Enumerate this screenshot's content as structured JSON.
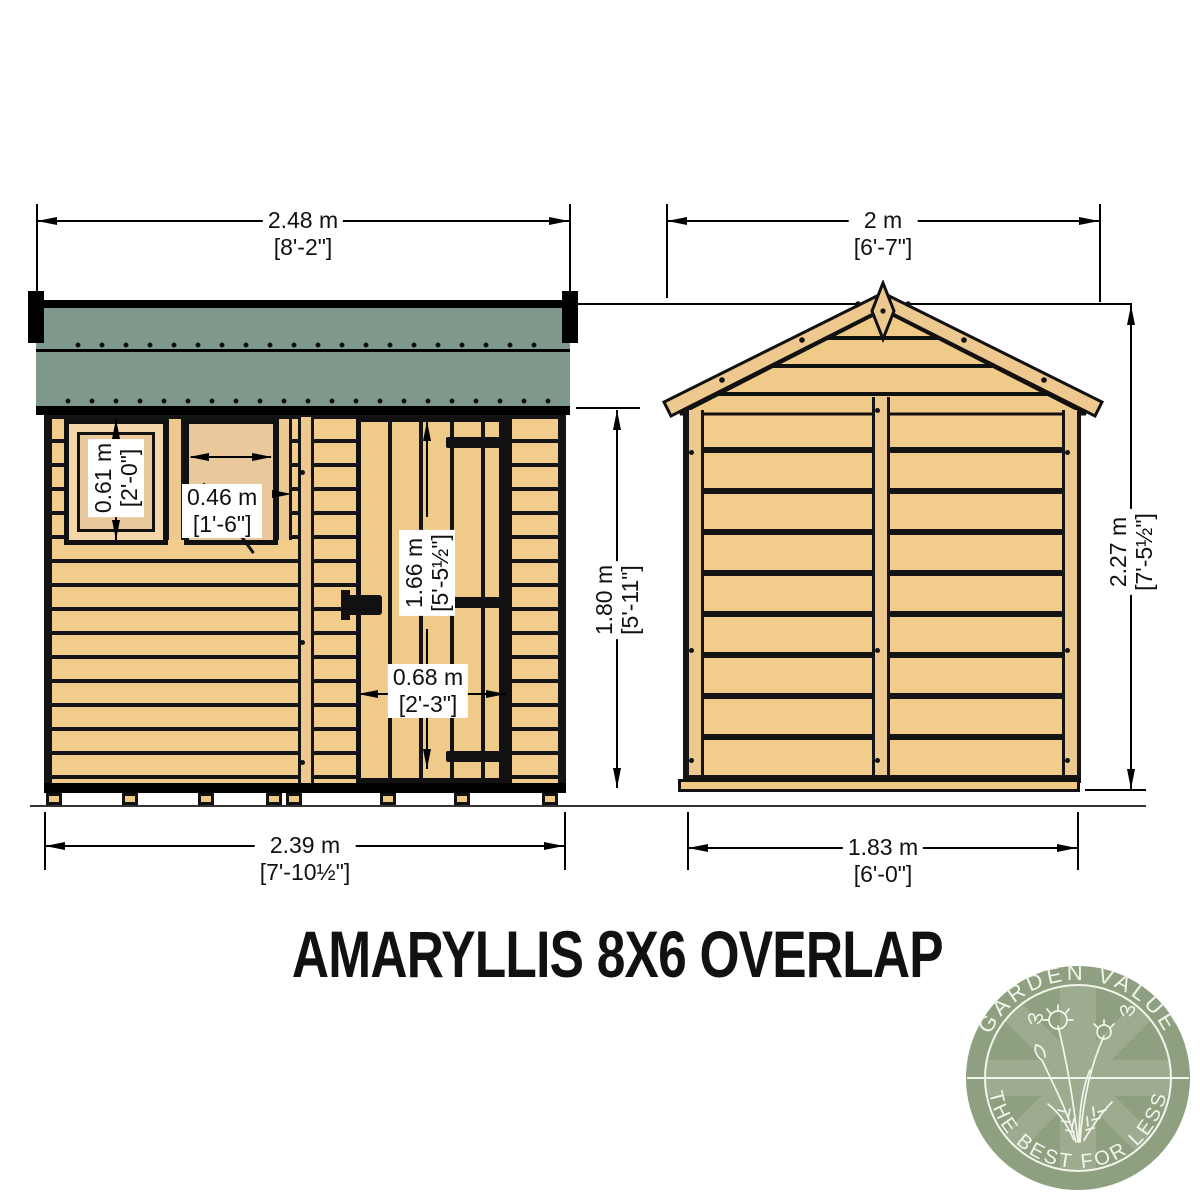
{
  "title": "AMARYLLIS 8X6 OVERLAP",
  "dimensions": {
    "front": {
      "roof_width": {
        "metric": "2.48 m",
        "imperial": "[8'-2\"]"
      },
      "base_width": {
        "metric": "2.39 m",
        "imperial": "[7'-10½\"]"
      },
      "wall_height": {
        "metric": "1.80 m",
        "imperial": "[5'-11\"]"
      },
      "window_height": {
        "metric": "0.61 m",
        "imperial": "[2'-0\"]"
      },
      "window_width": {
        "metric": "0.46 m",
        "imperial": "[1'-6\"]"
      },
      "door_height": {
        "metric": "1.66 m",
        "imperial": "[5'-5½\"]"
      },
      "door_width": {
        "metric": "0.68 m",
        "imperial": "[2'-3\"]"
      }
    },
    "side": {
      "overall_width": {
        "metric": "2 m",
        "imperial": "[6'-7\"]"
      },
      "base_width": {
        "metric": "1.83 m",
        "imperial": "[6'-0\"]"
      },
      "ridge_height": {
        "metric": "2.27 m",
        "imperial": "[7'-5½\"]"
      }
    }
  },
  "logo": {
    "arc_top": "GARDEN VALUE",
    "arc_bottom": "THE BEST FOR LESS"
  },
  "colors": {
    "timber": "#f2cc8b",
    "roof_felt": "#7e998c",
    "outline": "#141414",
    "logo_green": "#8fa081",
    "logo_green_light": "#9dac8e",
    "logo_text": "#f2f5ec"
  }
}
